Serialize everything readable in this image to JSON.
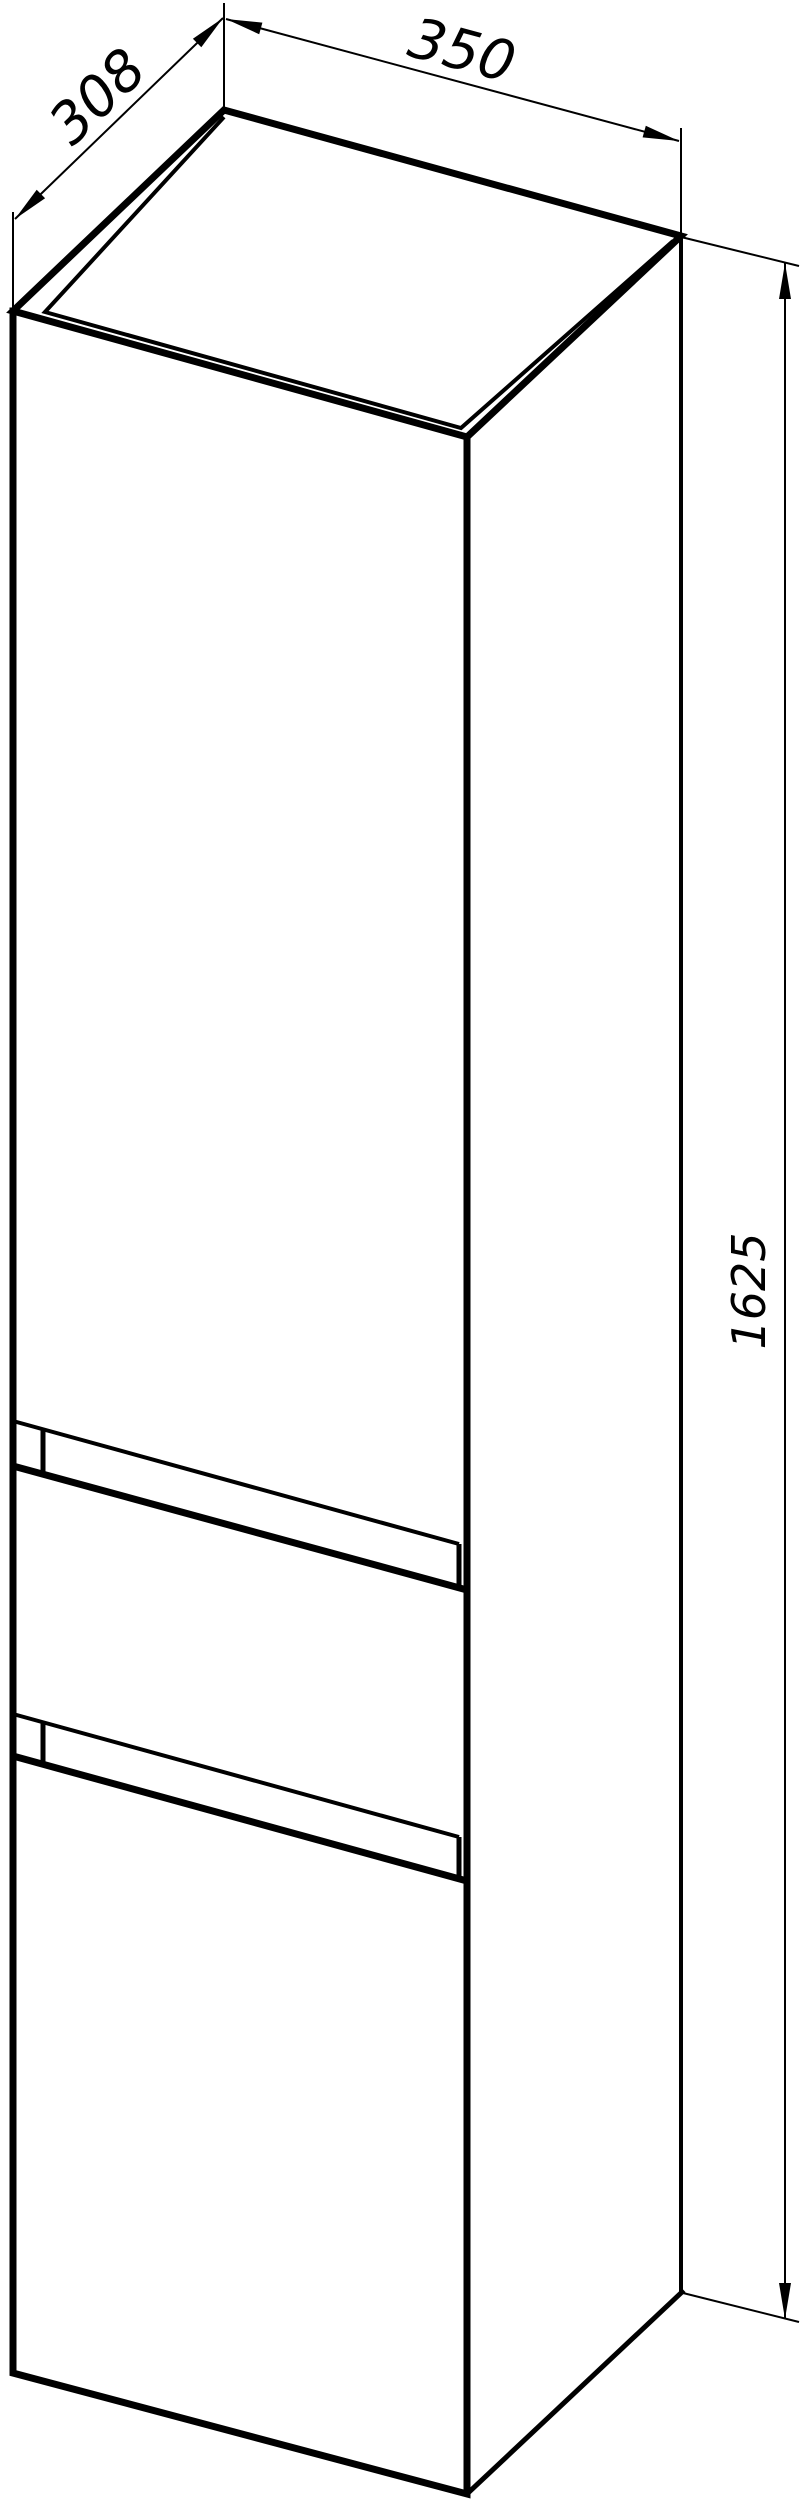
{
  "drawing": {
    "title": "cabinet-dimension-drawing",
    "dimensions": {
      "depth": {
        "label": "308",
        "value_mm": 308,
        "axis": "top-left-edge"
      },
      "width": {
        "label": "350",
        "value_mm": 350,
        "axis": "top-right-edge"
      },
      "height": {
        "label": "1625",
        "value_mm": 1625,
        "axis": "right-vertical"
      }
    },
    "features": {
      "handle_grooves": 2,
      "visible_faces": [
        "top",
        "front",
        "right-side"
      ]
    },
    "colors": {
      "line": "#000000",
      "background": "#ffffff"
    }
  }
}
